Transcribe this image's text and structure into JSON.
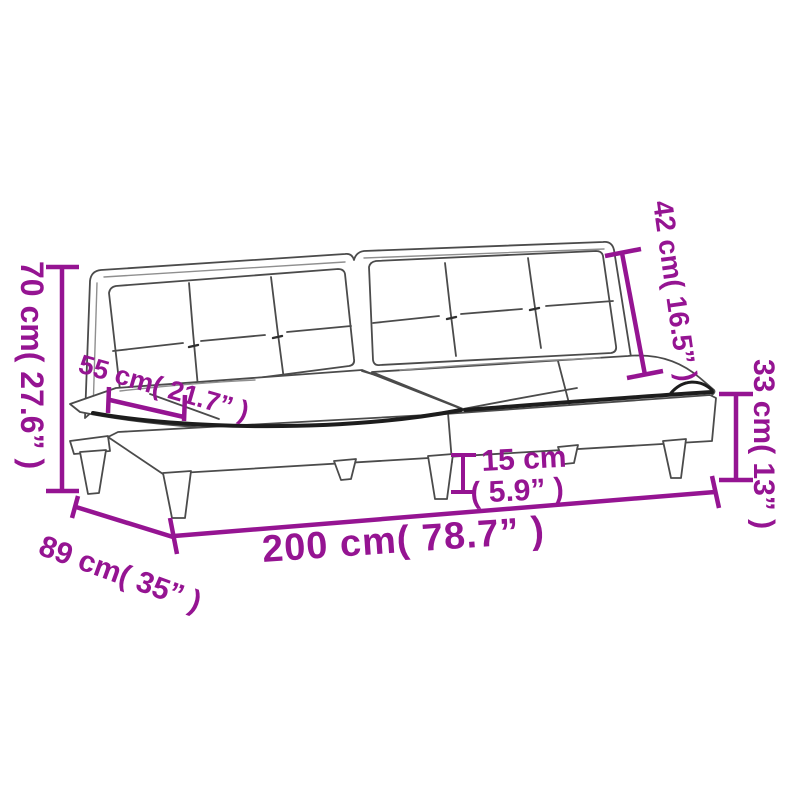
{
  "page": {
    "background": "#ffffff",
    "description": "Sofa bed product dimension diagram"
  },
  "colors": {
    "accent": "#951492",
    "line": "#4b4b4b",
    "shadow": "#1d1d1d"
  },
  "dimensions": {
    "height": "70 cm( 27.6” )",
    "seat_depth": "55 cm( 21.7” )",
    "backrest_height": "42 cm( 16.5” )",
    "seat_height": "33 cm( 13” )",
    "leg_height_cm": "15 cm",
    "leg_height_in": "( 5.9” )",
    "width": "200 cm( 78.7” )",
    "depth": "89 cm( 35” )"
  }
}
